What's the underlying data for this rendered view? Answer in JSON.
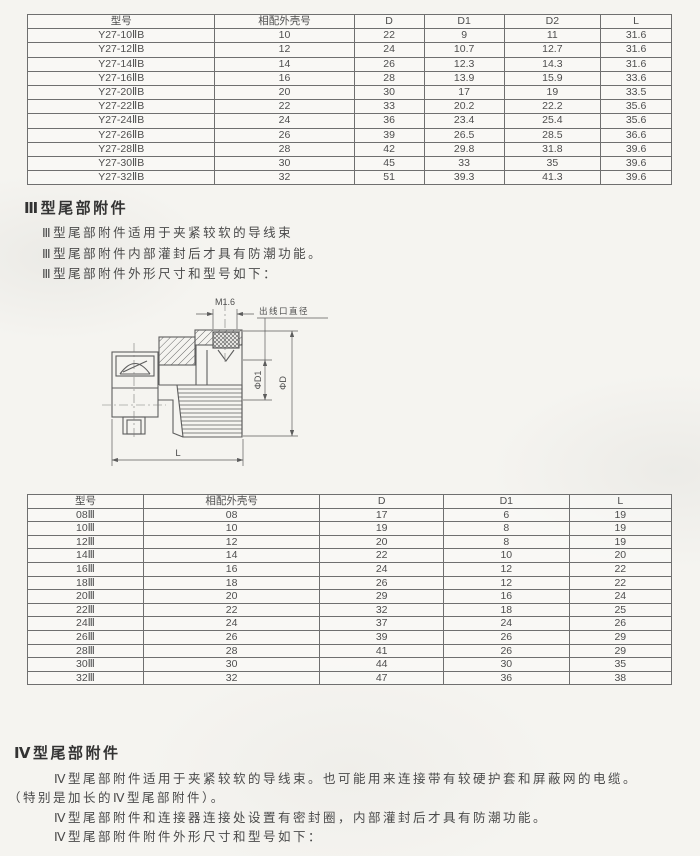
{
  "table1": {
    "headers": [
      "型号",
      "相配外壳号",
      "D",
      "D1",
      "D2",
      "L"
    ],
    "rows": [
      [
        "Y27-10ⅡB",
        "10",
        "22",
        "9",
        "11",
        "31.6"
      ],
      [
        "Y27-12ⅡB",
        "12",
        "24",
        "10.7",
        "12.7",
        "31.6"
      ],
      [
        "Y27-14ⅡB",
        "14",
        "26",
        "12.3",
        "14.3",
        "31.6"
      ],
      [
        "Y27-16ⅡB",
        "16",
        "28",
        "13.9",
        "15.9",
        "33.6"
      ],
      [
        "Y27-20ⅡB",
        "20",
        "30",
        "17",
        "19",
        "33.5"
      ],
      [
        "Y27-22ⅡB",
        "22",
        "33",
        "20.2",
        "22.2",
        "35.6"
      ],
      [
        "Y27-24ⅡB",
        "24",
        "36",
        "23.4",
        "25.4",
        "35.6"
      ],
      [
        "Y27-26ⅡB",
        "26",
        "39",
        "26.5",
        "28.5",
        "36.6"
      ],
      [
        "Y27-28ⅡB",
        "28",
        "42",
        "29.8",
        "31.8",
        "39.6"
      ],
      [
        "Y27-30ⅡB",
        "30",
        "45",
        "33",
        "35",
        "39.6"
      ],
      [
        "Y27-32ⅡB",
        "32",
        "51",
        "39.3",
        "41.3",
        "39.6"
      ]
    ]
  },
  "section3": {
    "title": "Ⅲ型尾部附件",
    "lines": [
      "Ⅲ型尾部附件适用于夹紧较软的导线束",
      "Ⅲ型尾部附件内部灌封后才具有防潮功能。",
      "Ⅲ型尾部附件外形尺寸和型号如下："
    ]
  },
  "drawing": {
    "thread_label": "M1.6",
    "outlet_label": "出线口直径",
    "d1_label": "ΦD1",
    "d_label": "ΦD",
    "length_label": "L"
  },
  "table2": {
    "headers": [
      "型号",
      "相配外壳号",
      "D",
      "D1",
      "L"
    ],
    "rows": [
      [
        "08Ⅲ",
        "08",
        "17",
        "6",
        "19"
      ],
      [
        "10Ⅲ",
        "10",
        "19",
        "8",
        "19"
      ],
      [
        "12Ⅲ",
        "12",
        "20",
        "8",
        "19"
      ],
      [
        "14Ⅲ",
        "14",
        "22",
        "10",
        "20"
      ],
      [
        "16Ⅲ",
        "16",
        "24",
        "12",
        "22"
      ],
      [
        "18Ⅲ",
        "18",
        "26",
        "12",
        "22"
      ],
      [
        "20Ⅲ",
        "20",
        "29",
        "16",
        "24"
      ],
      [
        "22Ⅲ",
        "22",
        "32",
        "18",
        "25"
      ],
      [
        "24Ⅲ",
        "24",
        "37",
        "24",
        "26"
      ],
      [
        "26Ⅲ",
        "26",
        "39",
        "26",
        "29"
      ],
      [
        "28Ⅲ",
        "28",
        "41",
        "26",
        "29"
      ],
      [
        "30Ⅲ",
        "30",
        "44",
        "30",
        "35"
      ],
      [
        "32Ⅲ",
        "32",
        "47",
        "36",
        "38"
      ]
    ]
  },
  "section4": {
    "title": "Ⅳ型尾部附件",
    "lines": [
      "Ⅳ型尾部附件适用于夹紧较软的导线束。也可能用来连接带有较硬护套和屏蔽网的电缆。",
      "（特别是加长的Ⅳ型尾部附件）。",
      "Ⅳ型尾部附件和连接器连接处设置有密封圈，内部灌封后才具有防潮功能。",
      "Ⅳ型尾部附件附件外形尺寸和型号如下："
    ]
  }
}
